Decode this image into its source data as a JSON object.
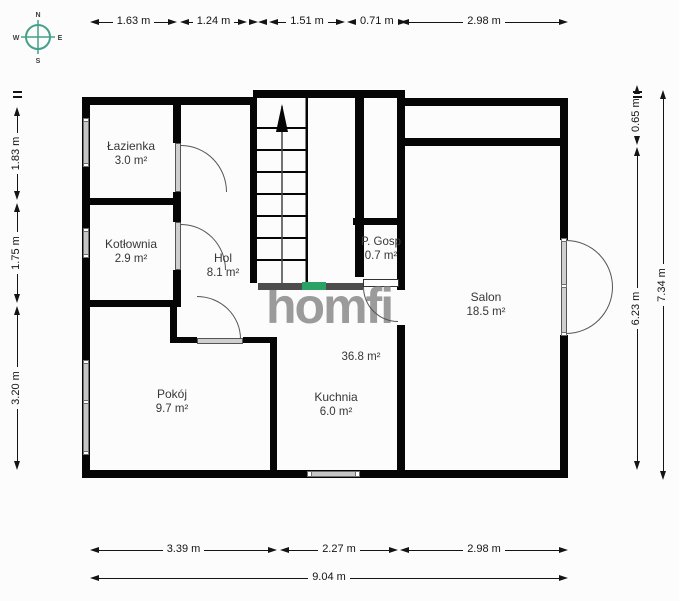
{
  "brand": {
    "watermark": "homfi"
  },
  "compass": {
    "n": "N",
    "e": "E",
    "s": "S",
    "w": "W"
  },
  "rooms": [
    {
      "name": "Łazienka",
      "area": "3.0 m²"
    },
    {
      "name": "Kotłownia",
      "area": "2.9 m²"
    },
    {
      "name": "Hol",
      "area": "8.1 m²"
    },
    {
      "name": "P. Gosp",
      "area": "0.7 m²"
    },
    {
      "name": "Salon",
      "area": "18.5 m²"
    },
    {
      "name": "Kuchnia",
      "area": "6.0 m²"
    },
    {
      "name": "Pokój",
      "area": "9.7 m²"
    }
  ],
  "open_area_label": "36.8 m²",
  "dimensions": {
    "top": [
      "1.63 m",
      "1.24 m",
      "1.51 m",
      "0.71 m",
      "2.98 m"
    ],
    "bottom": [
      "3.39 m",
      "2.27 m",
      "2.98 m"
    ],
    "bottom_total": "9.04 m",
    "left": [
      "1.83 m",
      "1.75 m",
      "3.20 m"
    ],
    "right": [
      "0.65 m",
      "6.23 m"
    ],
    "right_total": "7.34 m"
  },
  "colors": {
    "wall": "#060606",
    "accent_green": "#2aa265",
    "compass_teal": "#43a08a",
    "watermark_gray": "#9b9b9b"
  }
}
